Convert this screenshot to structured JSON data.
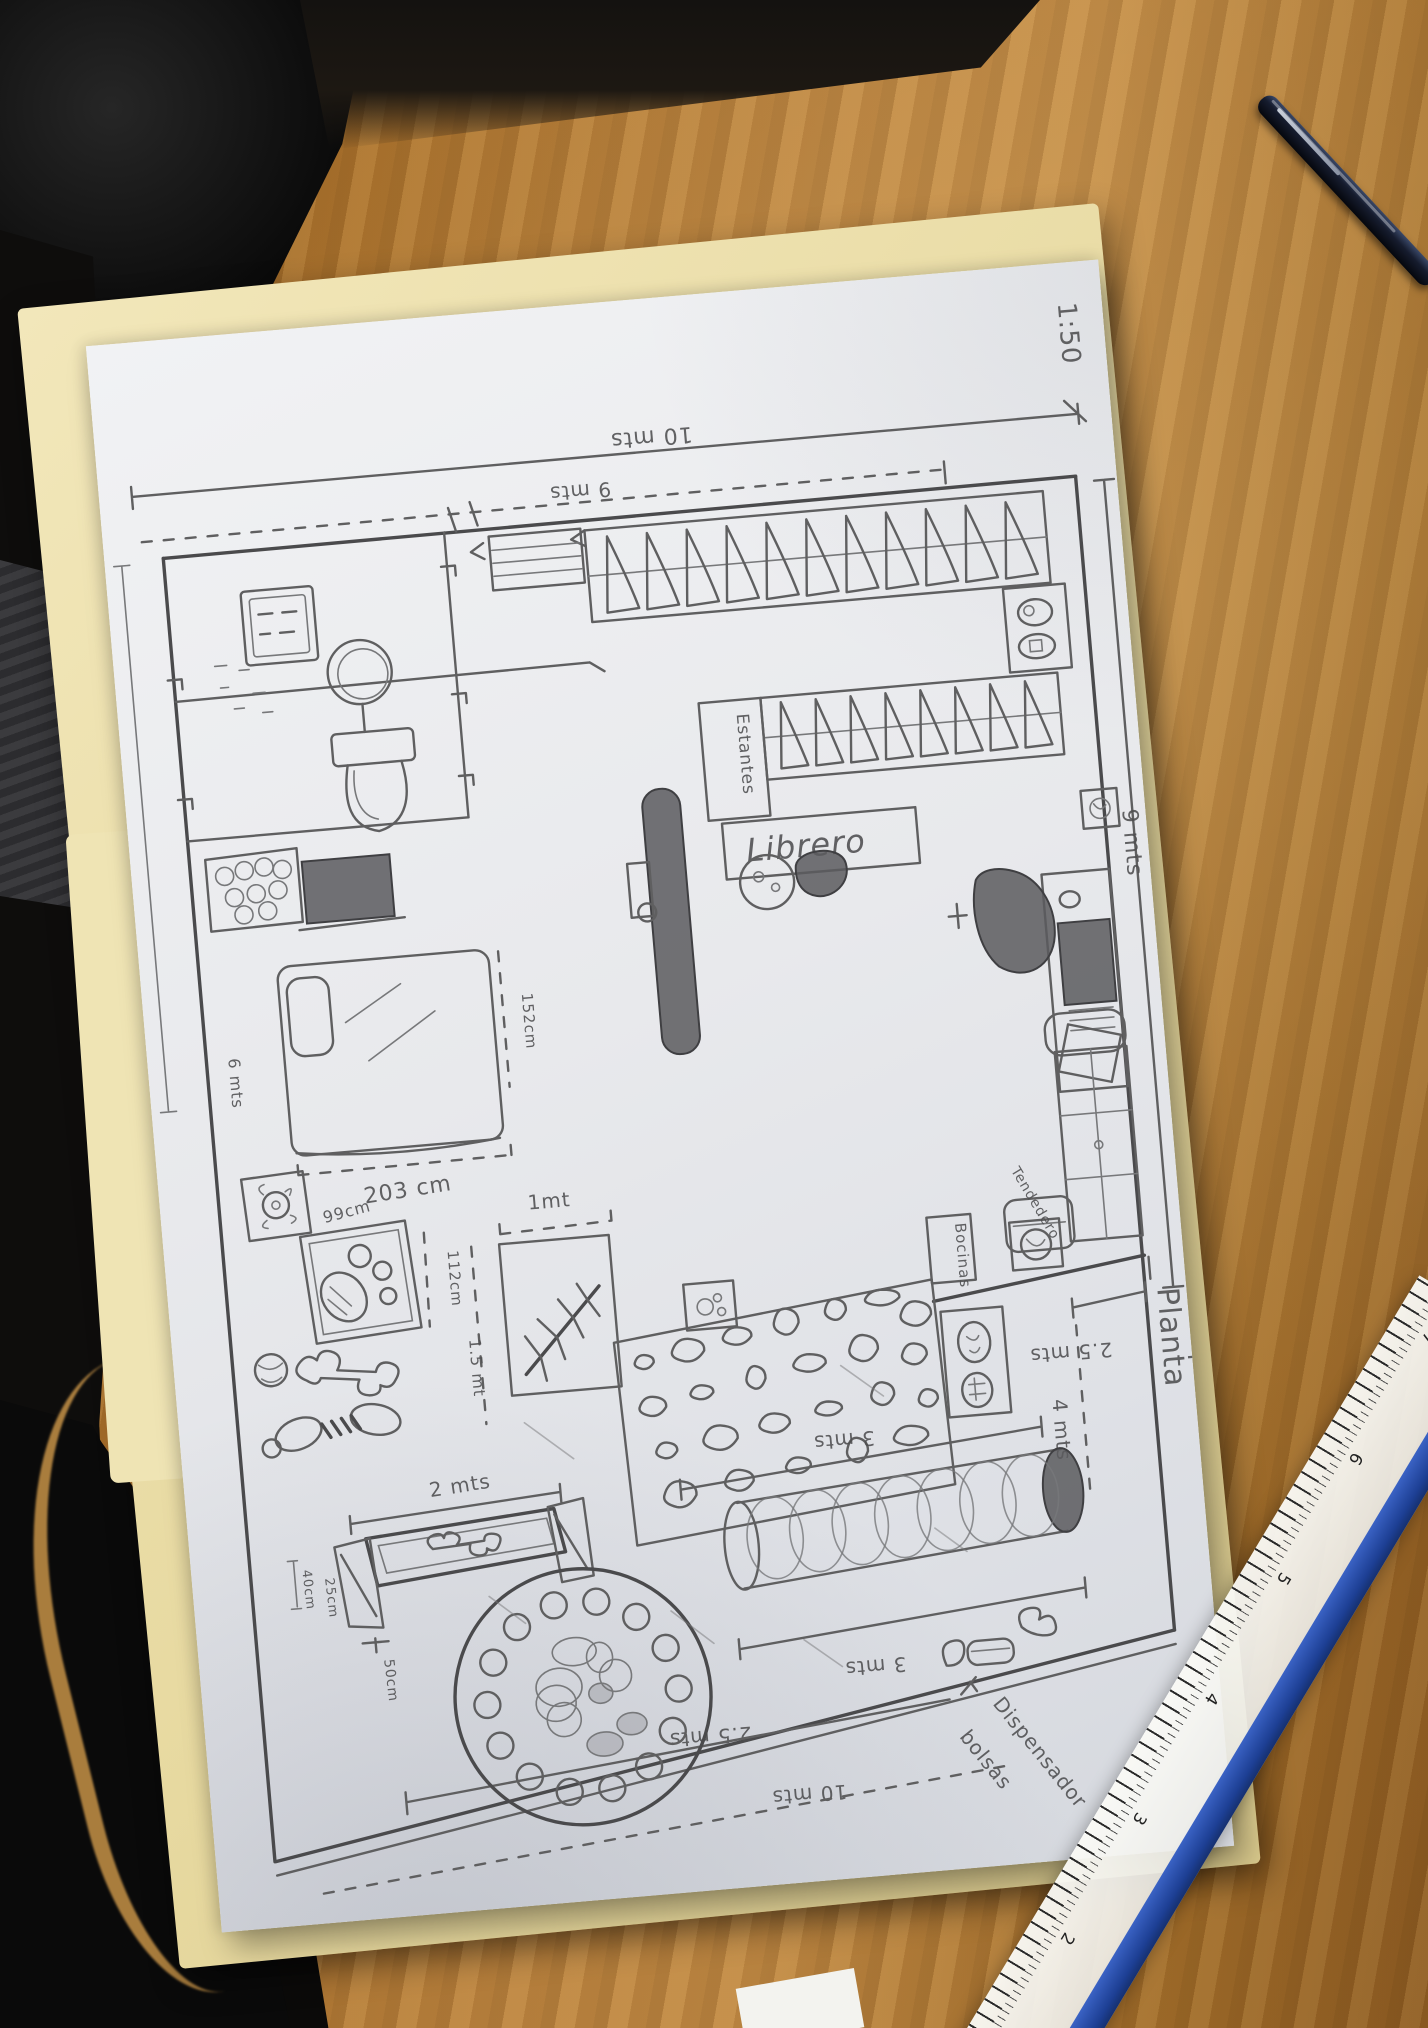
{
  "photo": {
    "scale_note": "1:50",
    "plan": {
      "title_1": "Planta",
      "title_2": "Arquitectonica",
      "dims": {
        "top_width": "10 mts",
        "top_inner": "9 mts",
        "right_height": "9 mts",
        "left_height": "6 mts",
        "bed_width": "203 cm",
        "bed_length": "152cm",
        "dogbed_width": "99cm",
        "dogbed_height": "112cm",
        "tree_width": "1mt",
        "tree_height": "1.5 mt",
        "bench_width": "2 mts",
        "bench_d1": "40cm",
        "bench_d2": "25cm",
        "bench_d3": "50cm",
        "patio_width": "2.5 mts",
        "patio_height": "4 mts",
        "tunnel_top": "3 mts",
        "tunnel_bottom": "3 mts",
        "bottom_inner": "2.5 mts",
        "bottom_width": "10 mts"
      },
      "labels": {
        "librero": "Librero",
        "estantes": "Estantes",
        "bocinas": "Bocinas",
        "tendedero": "Tendedero",
        "dispensador_1": "Dispensador",
        "dispensador_2": "bolsas"
      }
    },
    "ruler": {
      "numbers": [
        "7",
        "6",
        "5",
        "4",
        "3",
        "2"
      ]
    }
  }
}
